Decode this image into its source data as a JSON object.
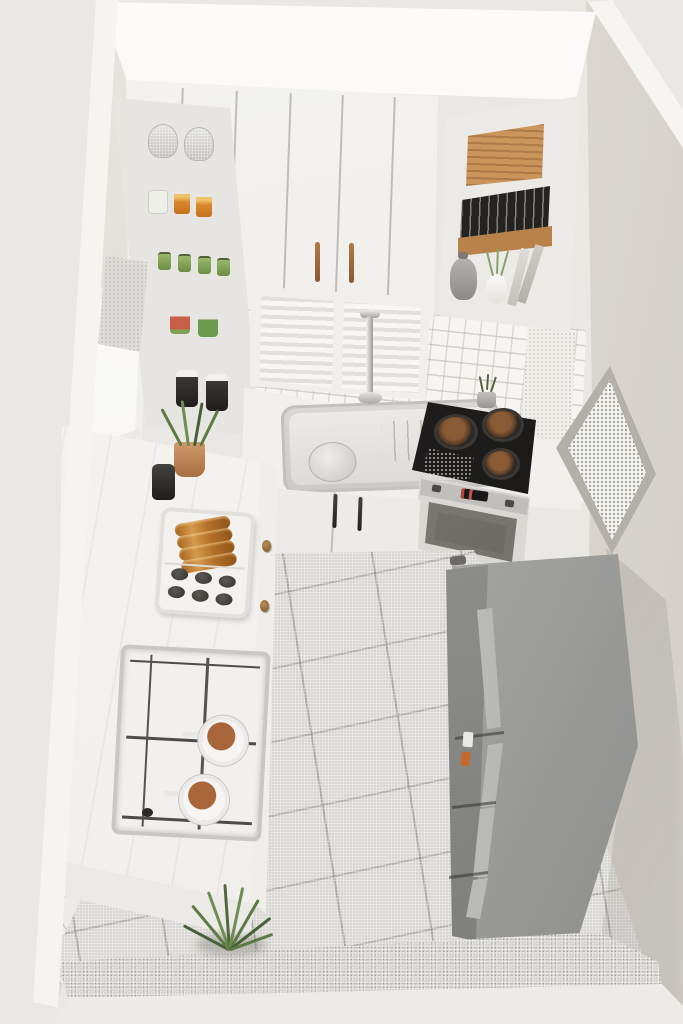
{
  "meta": {
    "type": "3d-architectural-render",
    "description": "Isometric cutaway dollhouse view of a small white kitchen seen from above",
    "view": "top-down isometric cutaway, three walls visible, front wall cut open",
    "visible_text": "none"
  },
  "palette": {
    "background": "#eae8e4",
    "ceiling": "#fbfaf8",
    "walls": "#e2dfda",
    "cabinets": "#f2f1ee",
    "countertop_marble": "#f5f4f1",
    "floor_tile": "#d9d7d3",
    "floor_grout": "#8a8882",
    "backsplash_tile": "#f6f5f2",
    "cooktop_black": "#1d1c1b",
    "fridge_steel": "#a8a8a6",
    "wood_handle": "#9a6a3a",
    "croissant": "#b4702a",
    "stone_dark": "#3c3936",
    "plant_green": "#5d7a45",
    "terracotta": "#b9834f"
  },
  "scene": {
    "ceiling": {
      "label": "white ceiling strip at top of cutaway"
    },
    "left_shelf_tower": {
      "label": "tall open shelving unit, left of back wall",
      "shelves": [
        {
          "contents": "two silver mesh canisters"
        },
        {
          "contents": "clear bag and two orange preserve jars"
        },
        {
          "contents": "four small green jars"
        },
        {
          "contents": "red-label can and green can"
        },
        {
          "contents": "two black jars with white lids"
        }
      ]
    },
    "upper_cabinets": {
      "label": "white upper cabinet row with vertical wooden handles",
      "handle_count": 2,
      "door_seams": 5
    },
    "right_shelf_tower": {
      "label": "open shelving unit, right of back wall",
      "shelves": [
        {
          "contents": "cork bread box"
        },
        {
          "contents": "row of dark books on cork slab"
        },
        {
          "contents": "gray kettle, white vase with grass, leaning cutting boards"
        }
      ]
    },
    "back_window": {
      "label": "window with closed white horizontal blinds, two panes"
    },
    "backsplash": {
      "label": "white square-tile backsplash"
    },
    "sink_area": {
      "label": "stainless steel sink with chrome faucet, round plate and drain grooves"
    },
    "cooktop": {
      "label": "black built-in cooktop with three dark pans and speckled grate"
    },
    "oven": {
      "label": "built-in oven with control panel, red digital display and glass door"
    },
    "base_cabinets": {
      "label": "white base cabinets with two black bar handles"
    },
    "wall_picture": {
      "label": "framed artwork on right wall seen at steep angle"
    },
    "island_counter": {
      "label": "white L-shaped marble counter along left wall",
      "items": [
        {
          "label": "white serving tray with four croissants and six dark stones"
        },
        {
          "label": "inset gas hob with wire grates and two white pots of food"
        },
        {
          "label": "potted green plant in terracotta pot"
        },
        {
          "label": "small black canister"
        },
        {
          "label": "round wooden drawer knobs on side face",
          "count": 5
        }
      ]
    },
    "fridge": {
      "label": "stainless steel refrigerator with freezer drawers, four handles, small orange magnet and note"
    },
    "floor": {
      "label": "light gray square tile floor"
    },
    "floor_plant": {
      "label": "spiky green plant on floor at end of island"
    },
    "left_window": {
      "label": "bright window on left wall"
    },
    "left_lower_wall": {
      "label": "white tiled lower section of left wall"
    },
    "cut_walls": {
      "label": "white cut edges of walls framing the scene"
    }
  }
}
